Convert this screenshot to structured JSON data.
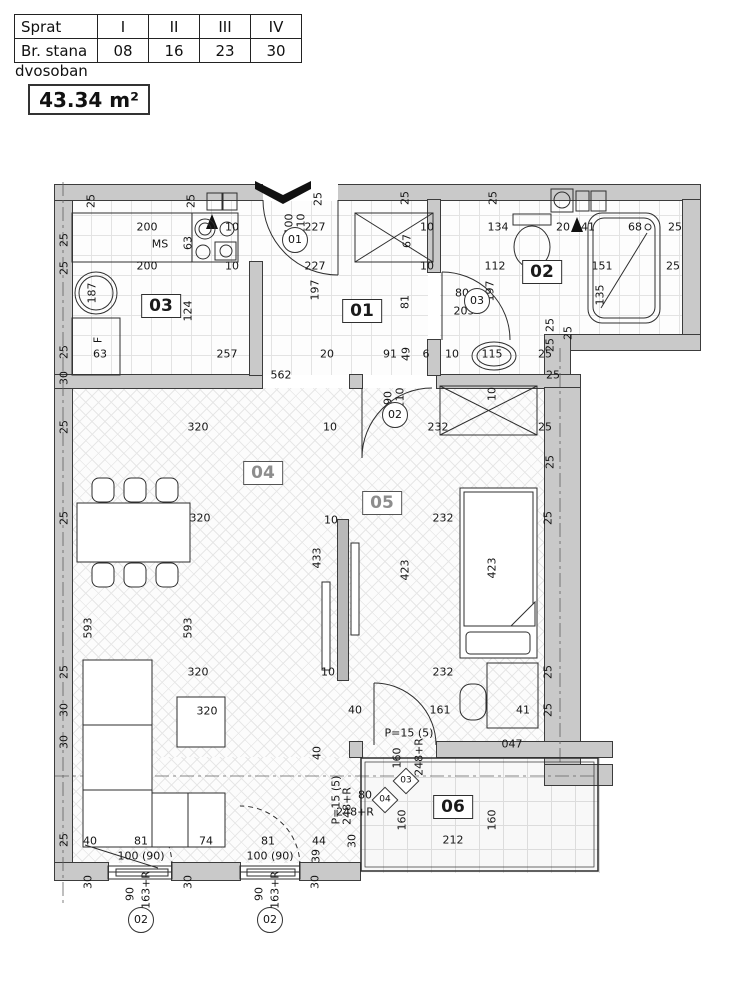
{
  "info_table": {
    "rows": [
      [
        "Sprat",
        "I",
        "II",
        "III",
        "IV"
      ],
      [
        "Br. stana",
        "08",
        "16",
        "23",
        "30"
      ]
    ]
  },
  "apartment_type": "dvosoban",
  "area": "43.34 m²",
  "colors": {
    "wall_fill": "#c9c9c9",
    "line": "#2e2e2e",
    "hatch": "#e7e7e7"
  },
  "plan": {
    "room_labels": [
      {
        "t": "01",
        "x": 362,
        "y": 311
      },
      {
        "t": "02",
        "x": 542,
        "y": 272
      },
      {
        "t": "03",
        "x": 161,
        "y": 306
      },
      {
        "t": "04",
        "x": 263,
        "y": 473,
        "m": 1
      },
      {
        "t": "05",
        "x": 382,
        "y": 503,
        "m": 1
      },
      {
        "t": "06",
        "x": 453,
        "y": 807
      }
    ],
    "circle_labels": [
      {
        "t": "01",
        "x": 295,
        "y": 240
      },
      {
        "t": "03",
        "x": 477,
        "y": 301
      },
      {
        "t": "02",
        "x": 395,
        "y": 415
      },
      {
        "t": "02",
        "x": 141,
        "y": 920
      },
      {
        "t": "02",
        "x": 270,
        "y": 920
      }
    ],
    "diamond_labels": [
      {
        "t": "03",
        "x": 406,
        "y": 781
      },
      {
        "t": "04",
        "x": 385,
        "y": 800
      }
    ],
    "dims": [
      {
        "t": "25",
        "x": 91,
        "y": 201,
        "r": 1
      },
      {
        "t": "25",
        "x": 191,
        "y": 201,
        "r": 1
      },
      {
        "t": "25",
        "x": 318,
        "y": 199,
        "r": 1
      },
      {
        "t": "25",
        "x": 405,
        "y": 198,
        "r": 1
      },
      {
        "t": "25",
        "x": 493,
        "y": 198,
        "r": 1
      },
      {
        "t": "200",
        "x": 147,
        "y": 227
      },
      {
        "t": "MS",
        "x": 160,
        "y": 244
      },
      {
        "t": "63",
        "x": 188,
        "y": 243,
        "r": 1
      },
      {
        "t": "10",
        "x": 232,
        "y": 227
      },
      {
        "t": "200",
        "x": 147,
        "y": 266
      },
      {
        "t": "10",
        "x": 232,
        "y": 266
      },
      {
        "t": "187",
        "x": 92,
        "y": 293,
        "r": 1
      },
      {
        "t": "124",
        "x": 188,
        "y": 311,
        "r": 1
      },
      {
        "t": "F",
        "x": 98,
        "y": 340,
        "r": 1
      },
      {
        "t": "63",
        "x": 100,
        "y": 354
      },
      {
        "t": "257",
        "x": 227,
        "y": 354
      },
      {
        "t": "100",
        "x": 289,
        "y": 224,
        "r": 1
      },
      {
        "t": "210",
        "x": 301,
        "y": 224,
        "r": 1
      },
      {
        "t": "227",
        "x": 315,
        "y": 227
      },
      {
        "t": "227",
        "x": 315,
        "y": 266
      },
      {
        "t": "10",
        "x": 427,
        "y": 227
      },
      {
        "t": "67",
        "x": 407,
        "y": 241,
        "r": 1
      },
      {
        "t": "10",
        "x": 427,
        "y": 266
      },
      {
        "t": "197",
        "x": 315,
        "y": 290,
        "r": 1
      },
      {
        "t": "81",
        "x": 405,
        "y": 302,
        "r": 1
      },
      {
        "t": "20",
        "x": 327,
        "y": 354
      },
      {
        "t": "91",
        "x": 390,
        "y": 354
      },
      {
        "t": "49",
        "x": 406,
        "y": 354,
        "r": 1
      },
      {
        "t": "6",
        "x": 426,
        "y": 354
      },
      {
        "t": "562",
        "x": 281,
        "y": 375
      },
      {
        "t": "134",
        "x": 498,
        "y": 227
      },
      {
        "t": "20",
        "x": 563,
        "y": 227
      },
      {
        "t": "41",
        "x": 588,
        "y": 227
      },
      {
        "t": "68",
        "x": 635,
        "y": 227
      },
      {
        "t": "25",
        "x": 675,
        "y": 227
      },
      {
        "t": "112",
        "x": 495,
        "y": 266
      },
      {
        "t": "151",
        "x": 602,
        "y": 266
      },
      {
        "t": "25",
        "x": 673,
        "y": 266
      },
      {
        "t": "197",
        "x": 490,
        "y": 291,
        "r": 1
      },
      {
        "t": "80",
        "x": 462,
        "y": 293
      },
      {
        "t": "205",
        "x": 464,
        "y": 311
      },
      {
        "t": "135",
        "x": 600,
        "y": 295,
        "r": 1
      },
      {
        "t": "25",
        "x": 568,
        "y": 333,
        "r": 1
      },
      {
        "t": "10",
        "x": 452,
        "y": 354
      },
      {
        "t": "115",
        "x": 492,
        "y": 354
      },
      {
        "t": "25",
        "x": 545,
        "y": 354
      },
      {
        "t": "25",
        "x": 553,
        "y": 375
      },
      {
        "t": "25",
        "x": 64,
        "y": 240,
        "r": 1
      },
      {
        "t": "25",
        "x": 64,
        "y": 268,
        "r": 1
      },
      {
        "t": "25",
        "x": 64,
        "y": 352,
        "r": 1
      },
      {
        "t": "30",
        "x": 64,
        "y": 378,
        "r": 1
      },
      {
        "t": "25",
        "x": 64,
        "y": 427,
        "r": 1
      },
      {
        "t": "25",
        "x": 64,
        "y": 518,
        "r": 1
      },
      {
        "t": "25",
        "x": 64,
        "y": 672,
        "r": 1
      },
      {
        "t": "30",
        "x": 64,
        "y": 710,
        "r": 1
      },
      {
        "t": "30",
        "x": 64,
        "y": 742,
        "r": 1
      },
      {
        "t": "25",
        "x": 64,
        "y": 840,
        "r": 1
      },
      {
        "t": "320",
        "x": 198,
        "y": 427
      },
      {
        "t": "10",
        "x": 330,
        "y": 427
      },
      {
        "t": "320",
        "x": 200,
        "y": 518
      },
      {
        "t": "10",
        "x": 331,
        "y": 520
      },
      {
        "t": "433",
        "x": 317,
        "y": 558,
        "r": 1
      },
      {
        "t": "593",
        "x": 88,
        "y": 628,
        "r": 1
      },
      {
        "t": "593",
        "x": 188,
        "y": 628,
        "r": 1
      },
      {
        "t": "320",
        "x": 198,
        "y": 672
      },
      {
        "t": "10",
        "x": 328,
        "y": 672
      },
      {
        "t": "320",
        "x": 207,
        "y": 711
      },
      {
        "t": "40",
        "x": 317,
        "y": 753,
        "r": 1
      },
      {
        "t": "P=15 (5)",
        "x": 336,
        "y": 800,
        "r": 1
      },
      {
        "t": "248+R",
        "x": 347,
        "y": 806,
        "r": 1
      },
      {
        "t": "90",
        "x": 388,
        "y": 398,
        "r": 1
      },
      {
        "t": "210",
        "x": 400,
        "y": 398,
        "r": 1
      },
      {
        "t": "232",
        "x": 438,
        "y": 427
      },
      {
        "t": "10",
        "x": 492,
        "y": 394,
        "r": 1
      },
      {
        "t": "25",
        "x": 545,
        "y": 427
      },
      {
        "t": "232",
        "x": 443,
        "y": 518
      },
      {
        "t": "25",
        "x": 548,
        "y": 518,
        "r": 1
      },
      {
        "t": "423",
        "x": 405,
        "y": 570,
        "r": 1
      },
      {
        "t": "423",
        "x": 492,
        "y": 568,
        "r": 1
      },
      {
        "t": "232",
        "x": 443,
        "y": 672
      },
      {
        "t": "25",
        "x": 548,
        "y": 672,
        "r": 1
      },
      {
        "t": "40",
        "x": 355,
        "y": 710
      },
      {
        "t": "161",
        "x": 440,
        "y": 710
      },
      {
        "t": "41",
        "x": 523,
        "y": 710
      },
      {
        "t": "25",
        "x": 548,
        "y": 710,
        "r": 1
      },
      {
        "t": "25",
        "x": 550,
        "y": 325,
        "r": 1
      },
      {
        "t": "25",
        "x": 550,
        "y": 345,
        "r": 1
      },
      {
        "t": "25",
        "x": 550,
        "y": 462,
        "r": 1
      },
      {
        "t": "P=15 (5)",
        "x": 409,
        "y": 733
      },
      {
        "t": "248+R",
        "x": 419,
        "y": 757,
        "r": 1
      },
      {
        "t": "160",
        "x": 397,
        "y": 758,
        "r": 1
      },
      {
        "t": "047",
        "x": 512,
        "y": 744
      },
      {
        "t": "80",
        "x": 365,
        "y": 795
      },
      {
        "t": "248+R",
        "x": 355,
        "y": 812
      },
      {
        "t": "160",
        "x": 402,
        "y": 820,
        "r": 1
      },
      {
        "t": "160",
        "x": 492,
        "y": 820,
        "r": 1
      },
      {
        "t": "212",
        "x": 453,
        "y": 840
      },
      {
        "t": "30",
        "x": 352,
        "y": 841,
        "r": 1
      },
      {
        "t": "40",
        "x": 90,
        "y": 841
      },
      {
        "t": "81",
        "x": 141,
        "y": 841
      },
      {
        "t": "74",
        "x": 206,
        "y": 841
      },
      {
        "t": "81",
        "x": 268,
        "y": 841
      },
      {
        "t": "44",
        "x": 319,
        "y": 841
      },
      {
        "t": "39",
        "x": 316,
        "y": 856,
        "r": 1
      },
      {
        "t": "100 (90)",
        "x": 141,
        "y": 856
      },
      {
        "t": "100 (90)",
        "x": 270,
        "y": 856
      },
      {
        "t": "30",
        "x": 88,
        "y": 882,
        "r": 1
      },
      {
        "t": "30",
        "x": 188,
        "y": 882,
        "r": 1
      },
      {
        "t": "30",
        "x": 315,
        "y": 882,
        "r": 1
      },
      {
        "t": "90",
        "x": 130,
        "y": 894,
        "r": 1
      },
      {
        "t": "163+R",
        "x": 146,
        "y": 890,
        "r": 1
      },
      {
        "t": "90",
        "x": 259,
        "y": 894,
        "r": 1
      },
      {
        "t": "163+R",
        "x": 275,
        "y": 890,
        "r": 1
      }
    ]
  }
}
